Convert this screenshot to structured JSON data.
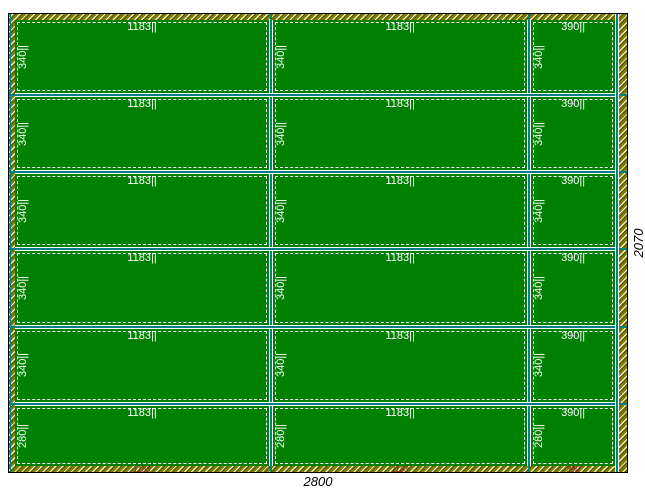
{
  "sheet": {
    "width_dimension": "2800",
    "height_dimension": "2070"
  },
  "columns": [
    {
      "width": 1183,
      "panel_width_label": "1183||",
      "cut_width_label": "1183"
    },
    {
      "width": 1183,
      "panel_width_label": "1183||",
      "cut_width_label": "1183"
    },
    {
      "width": 390,
      "panel_width_label": "390||",
      "cut_width_label": "390"
    }
  ],
  "rows": [
    {
      "height": 340,
      "panel_height_label": "340||"
    },
    {
      "height": 340,
      "panel_height_label": "340||"
    },
    {
      "height": 340,
      "panel_height_label": "340||"
    },
    {
      "height": 340,
      "panel_height_label": "340||"
    },
    {
      "height": 340,
      "panel_height_label": "340||"
    },
    {
      "height": 280,
      "panel_height_label": "280||"
    }
  ],
  "colors": {
    "panel_fill": "#008000",
    "panel_border": "#ffffff",
    "hatch_base": "#808000",
    "cut_line": "#008080",
    "cut_dimension_text": "#8b1a1a",
    "dimension_text": "#000000"
  }
}
